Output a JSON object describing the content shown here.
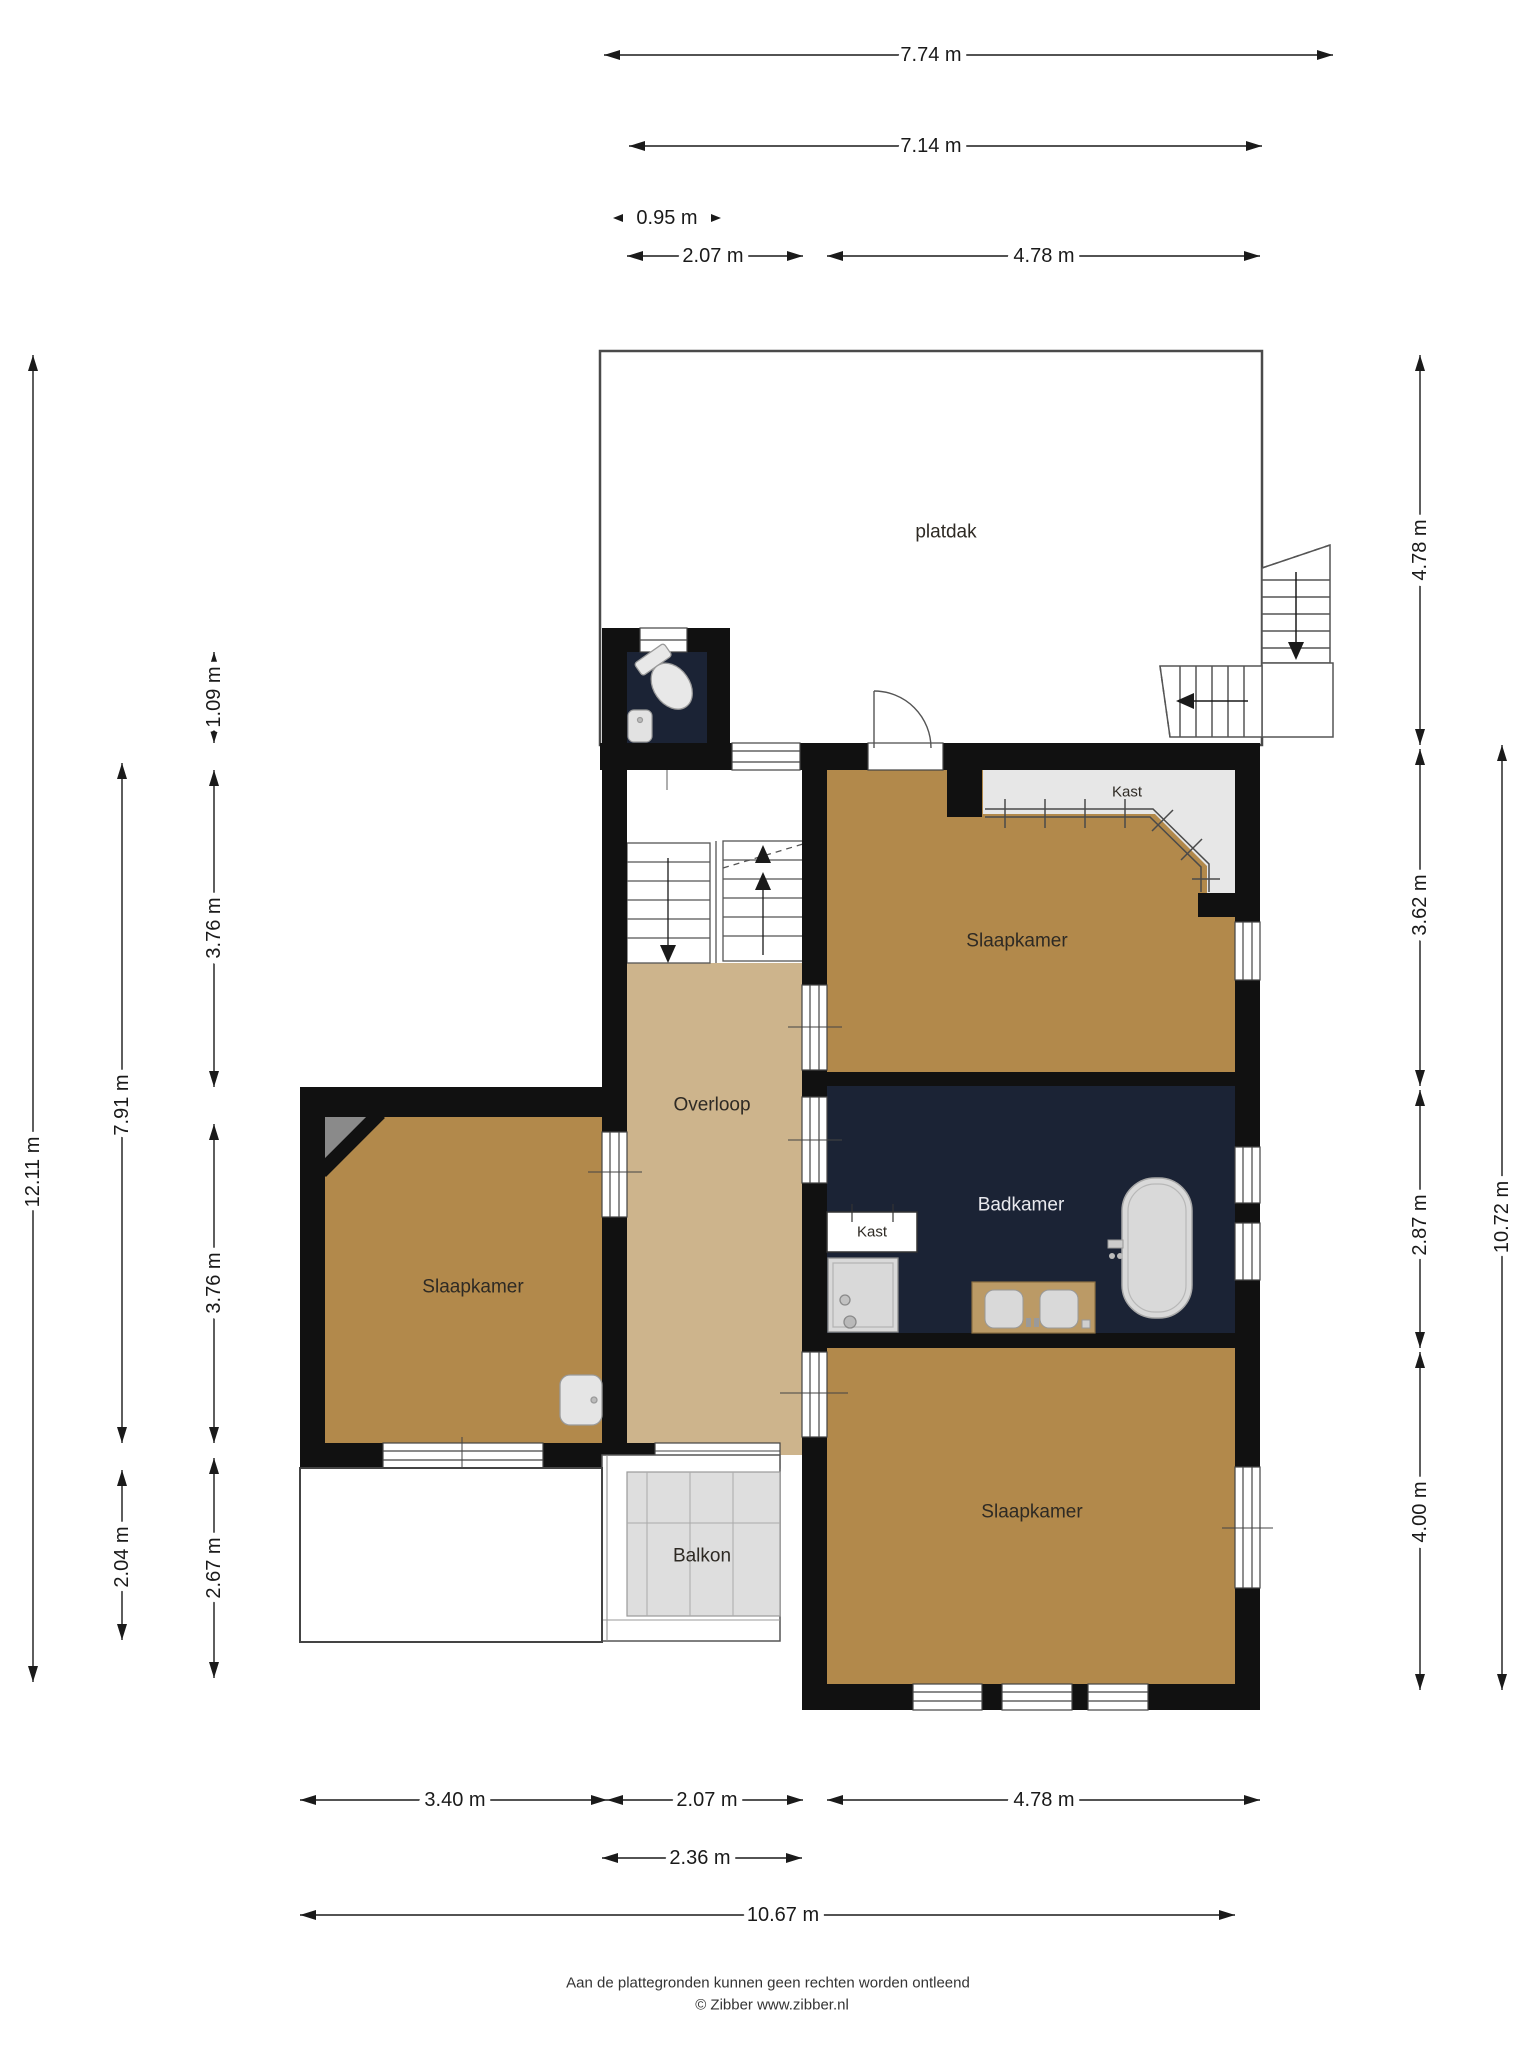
{
  "rooms": {
    "platdak": {
      "label": "platdak"
    },
    "bedroom_top_right": {
      "label": "Slaapkamer"
    },
    "bedroom_left": {
      "label": "Slaapkamer"
    },
    "bedroom_bottom": {
      "label": "Slaapkamer"
    },
    "overloop": {
      "label": "Overloop"
    },
    "badkamer": {
      "label": "Badkamer"
    },
    "kast_bedroom": {
      "label": "Kast"
    },
    "kast_badkamer": {
      "label": "Kast"
    },
    "balkon": {
      "label": "Balkon"
    }
  },
  "dimensions": {
    "top": [
      {
        "label": "7.74 m"
      },
      {
        "label": "7.14 m"
      },
      {
        "label": "0.95 m"
      },
      {
        "label": "2.07 m"
      },
      {
        "label": "4.78 m"
      }
    ],
    "bottom": [
      {
        "label": "3.40 m"
      },
      {
        "label": "2.07 m"
      },
      {
        "label": "4.78 m"
      },
      {
        "label": "2.36 m"
      },
      {
        "label": "10.67 m"
      }
    ],
    "left": [
      {
        "label": "12.11 m"
      },
      {
        "label": "7.91 m"
      },
      {
        "label": "2.04 m"
      },
      {
        "label": "1.09 m"
      },
      {
        "label": "3.76 m"
      },
      {
        "label": "3.76 m"
      },
      {
        "label": "2.67 m"
      }
    ],
    "right": [
      {
        "label": "4.78 m"
      },
      {
        "label": "3.62 m"
      },
      {
        "label": "2.87 m"
      },
      {
        "label": "4.00 m"
      },
      {
        "label": "10.72 m"
      }
    ]
  },
  "footer": {
    "line1": "Aan de plattegronden kunnen geen rechten worden ontleend",
    "line2": "© Zibber www.zibber.nl"
  },
  "colors": {
    "wall": "#111111",
    "floor_bedroom": "#b2894b",
    "floor_overloop": "#cdb48c",
    "floor_bath": "#1b2335",
    "closet_gray": "#e7e7e7",
    "balcony_gray": "#dedede"
  }
}
